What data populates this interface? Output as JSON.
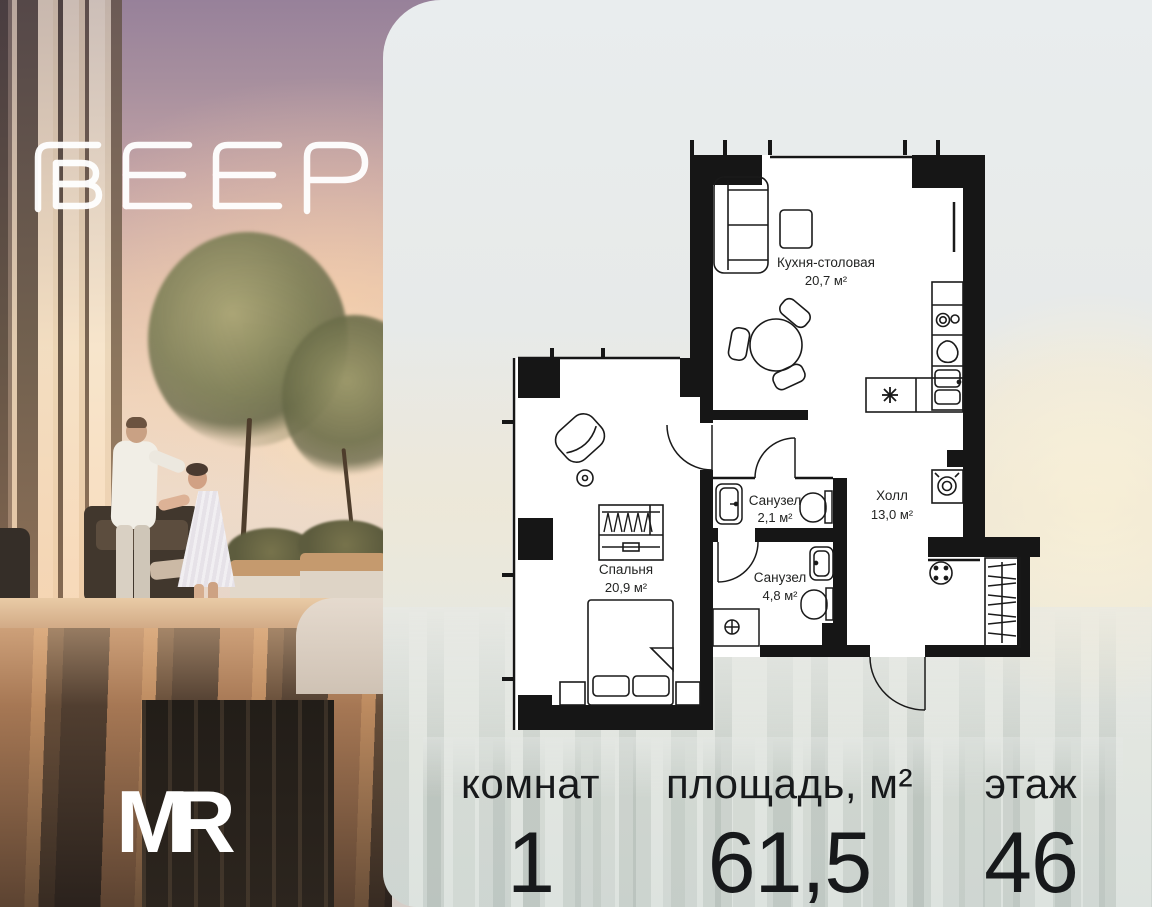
{
  "logo": {
    "brand": "ВЕЕР",
    "developer": "MR"
  },
  "floorplan": {
    "rooms": [
      {
        "name": "Кухня-столовая",
        "area": "20,7 м²"
      },
      {
        "name": "Санузел",
        "area": "2,1 м²"
      },
      {
        "name": "Санузел",
        "area": "4,8 м²"
      },
      {
        "name": "Холл",
        "area": "13,0 м²"
      },
      {
        "name": "Спальня",
        "area": "20,9 м²"
      }
    ]
  },
  "stats": {
    "columns": [
      {
        "label": "комнат",
        "value": "1"
      },
      {
        "label": "площадь, м²",
        "value": "61,5"
      },
      {
        "label": "этаж",
        "value": "46"
      }
    ]
  },
  "colors": {
    "wall": "#161616",
    "floor": "#ffffff",
    "card_bg": "#e8ebea",
    "text": "#17191b",
    "logo": "#ffffff"
  }
}
